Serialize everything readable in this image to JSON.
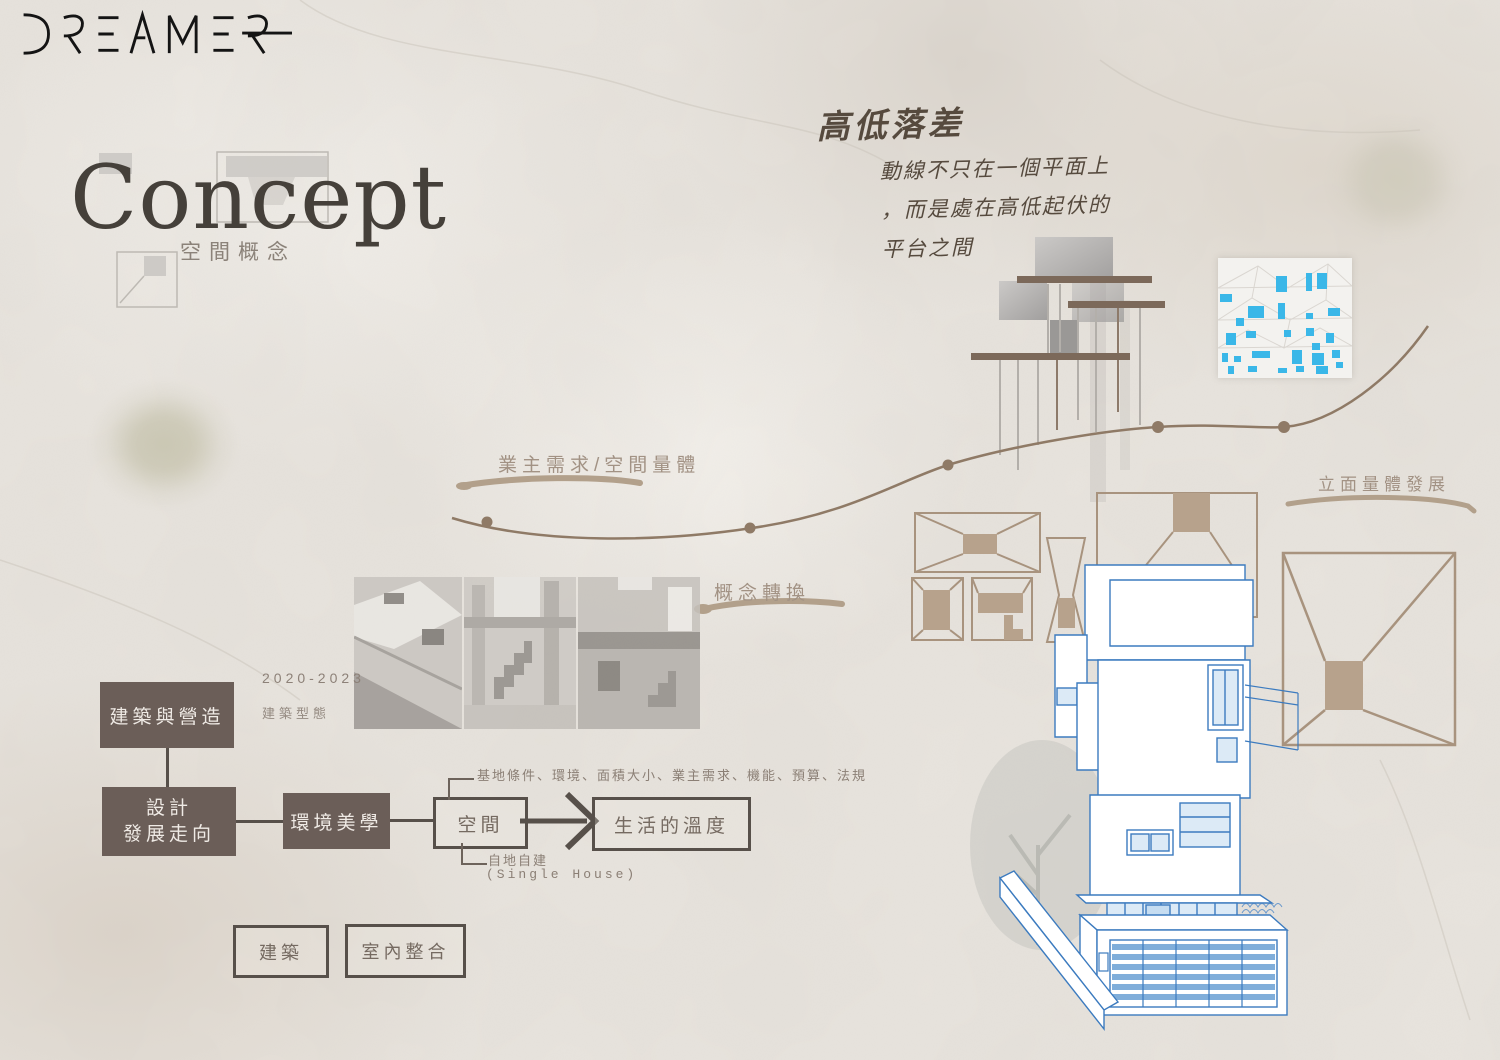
{
  "poster": {
    "brand_logo": "DREAMER",
    "title": "Concept",
    "subtitle": "空間概念",
    "note": {
      "heading": "高低落差",
      "lines": [
        "動線不只在一個平面上",
        "，而是處在高低起伏的",
        "平台之間"
      ]
    },
    "labels": {
      "owner_needs": "業主需求/空間量體",
      "concept_transform": "概念轉換",
      "facade_dev": "立面量體發展"
    },
    "timeline": {
      "years": "2020-2023",
      "caption": "建築型態"
    },
    "flow": {
      "construction": "建築與營造",
      "design_line1": "設計",
      "design_line2": "發展走向",
      "aesthetics": "環境美學",
      "space": "空間",
      "result": "生活的溫度",
      "conditions": "基地條件、環境、面積大小、業主需求、機能、預算、法規",
      "self_build": "自地自建",
      "self_build_en": "(Single House)",
      "architecture": "建築",
      "interior": "室內整合"
    }
  },
  "colors": {
    "background": "#e9e5df",
    "box_fill": "#6b5e58",
    "box_border": "#57504a",
    "label_taupe": "#a29284",
    "tan_outline": "#a8937e",
    "tan_fill": "#b7a28c",
    "curve_brown": "#8f7a66",
    "brush": "#b2a08b",
    "platform_bar": "#7c695a",
    "blueprint_line": "#3c7bbf",
    "cyan": "#3ab7e8",
    "ink": "#141414"
  },
  "facade_study": {
    "windows": [
      [
        58,
        18,
        11,
        16
      ],
      [
        88,
        15,
        6,
        18
      ],
      [
        99,
        15,
        10,
        16
      ],
      [
        2,
        36,
        12,
        8
      ],
      [
        30,
        48,
        16,
        12
      ],
      [
        60,
        45,
        7,
        16
      ],
      [
        88,
        55,
        7,
        6
      ],
      [
        18,
        60,
        8,
        8
      ],
      [
        110,
        50,
        12,
        8
      ],
      [
        8,
        75,
        10,
        12
      ],
      [
        28,
        73,
        10,
        7
      ],
      [
        66,
        72,
        7,
        7
      ],
      [
        88,
        70,
        8,
        8
      ],
      [
        108,
        75,
        8,
        10
      ],
      [
        94,
        85,
        8,
        7
      ],
      [
        4,
        95,
        6,
        9
      ],
      [
        16,
        98,
        7,
        6
      ],
      [
        34,
        93,
        18,
        7
      ],
      [
        74,
        92,
        10,
        14
      ],
      [
        94,
        95,
        12,
        12
      ],
      [
        114,
        92,
        8,
        8
      ],
      [
        10,
        108,
        6,
        8
      ],
      [
        30,
        108,
        9,
        6
      ],
      [
        60,
        110,
        9,
        5
      ],
      [
        78,
        108,
        8,
        6
      ],
      [
        98,
        108,
        12,
        8
      ],
      [
        118,
        104,
        7,
        6
      ]
    ]
  }
}
